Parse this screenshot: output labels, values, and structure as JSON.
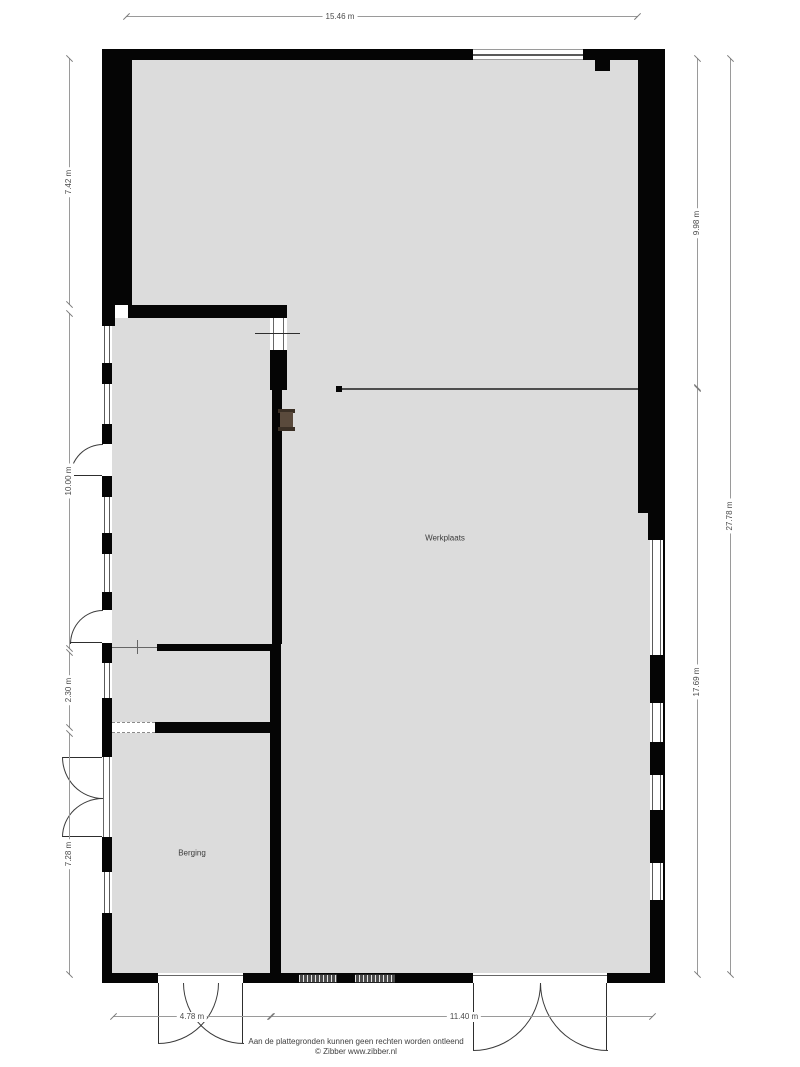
{
  "floorplan": {
    "room_labels": [
      "Werkplaats",
      "Berging"
    ],
    "dimensions": {
      "top": "15.46 m",
      "left": [
        "7.42 m",
        "10.00 m",
        "2.30 m",
        "7.28 m"
      ],
      "right": [
        "9.98 m",
        "17.69 m",
        "27.78 m"
      ],
      "bottom": [
        "4.78 m",
        "11.40 m"
      ]
    },
    "footer": [
      "Aan de plattegronden kunnen geen rechten worden ontleend",
      "© Zibber www.zibber.nl"
    ],
    "colors": {
      "wall": "#050505",
      "floor": "#dcdcdc",
      "dimension_text": "#4a4a4a",
      "dimension_line": "#9a9a9a",
      "wall_object_brown": "#5a4a3c"
    }
  }
}
